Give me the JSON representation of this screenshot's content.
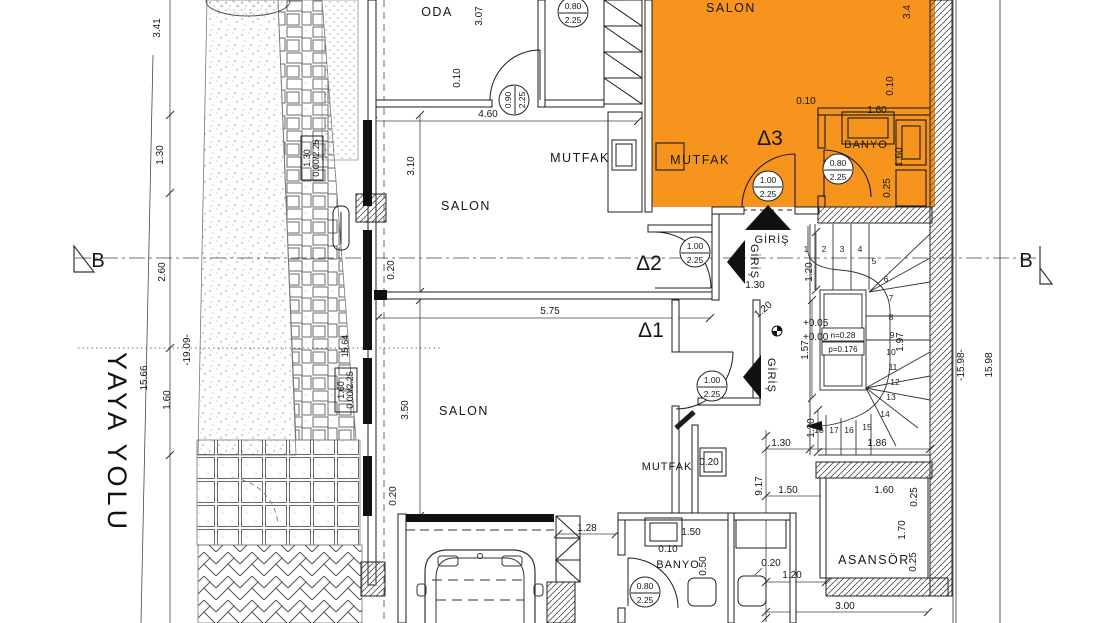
{
  "site": {
    "yaya_yolu": "YAYA YOLU"
  },
  "section": {
    "label": "B"
  },
  "units": {
    "d1": "Δ1",
    "d2": "Δ2",
    "d3": "Δ3"
  },
  "rooms": {
    "oda": "ODA",
    "salon": "SALON",
    "mutfak": "MUTFAK",
    "banyo": "BANYO",
    "asansor": "ASANSÖR",
    "giris": "GİRİŞ"
  },
  "doors": {
    "d100": {
      "w": "1.00",
      "h": "2.25"
    },
    "d080": {
      "w": "0.80",
      "h": "2.25"
    },
    "d090": {
      "w": "0.90",
      "h": "2.25"
    }
  },
  "windows": {
    "w130": {
      "w": "1.30",
      "h": "0.00/2.25"
    },
    "w160": {
      "w": "1.60",
      "h": "0.00/2.25"
    }
  },
  "stairs": {
    "n": "n=0.28",
    "p": "p=0.176",
    "steps": [
      "1",
      "2",
      "3",
      "4",
      "5",
      "6",
      "7",
      "8",
      "9",
      "10",
      "11",
      "12",
      "13",
      "14",
      "15",
      "16",
      "17",
      "18"
    ]
  },
  "levels": {
    "upper": "+0.05",
    "lower": "+0.00"
  },
  "dims": {
    "d341": "3.41",
    "d130": "1.30",
    "d260": "2.60",
    "d1566": "15.66",
    "d160": "1.60",
    "d1909": "-19.09-",
    "d1564": "15.64",
    "d307": "3.07",
    "d010": "0.10",
    "d460": "4.60",
    "d310": "3.10",
    "d020": "0.20",
    "d575": "5.75",
    "d350": "3.50",
    "d120": "1.20",
    "d157": "1.57",
    "d917": "9.17",
    "d150": "1.50",
    "d128": "1.28",
    "d186": "1.86",
    "d197": "1.97",
    "d1598neg": "-15.98-",
    "d1598": "15.98",
    "d300": "3.00",
    "d170": "1.70",
    "d025": "0.25",
    "d050": "0.50",
    "d34": "3.4"
  },
  "colors": {
    "highlight": "#F7941E",
    "line": "#1a1a1a"
  }
}
